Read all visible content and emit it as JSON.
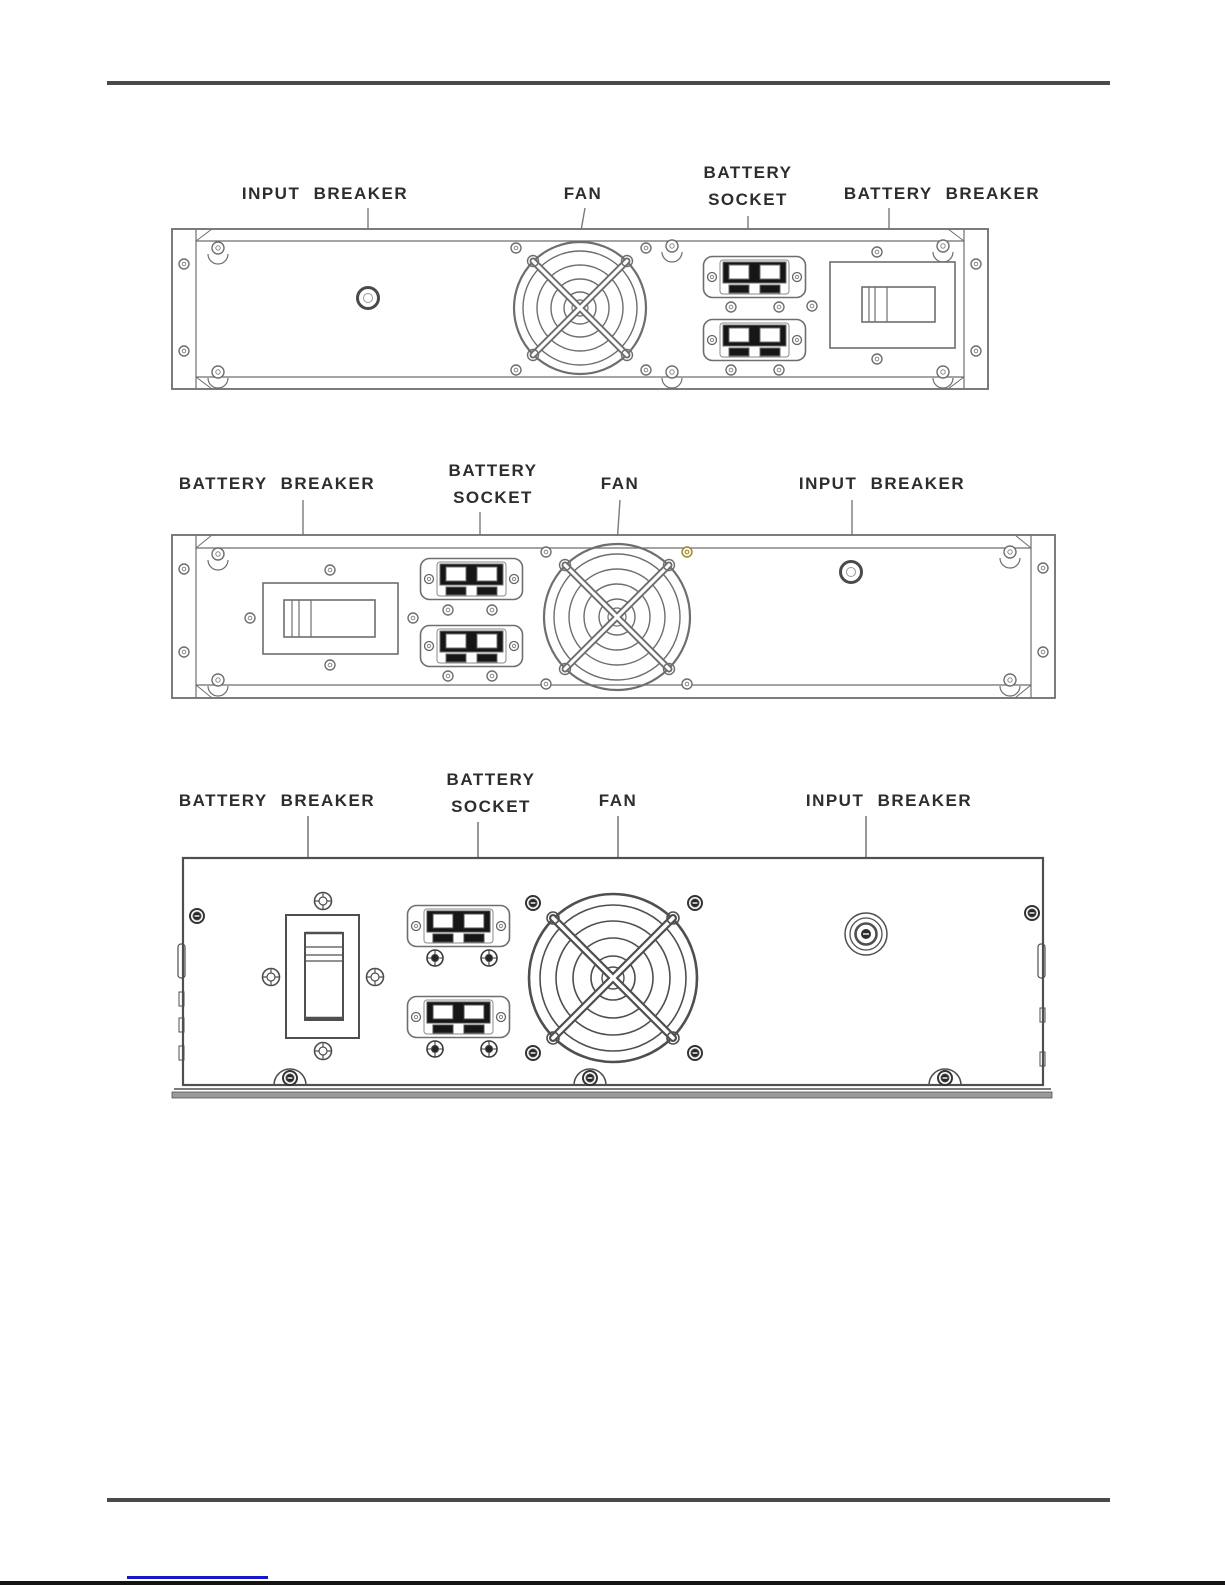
{
  "diagrams": [
    {
      "position": "top",
      "unit": "battery-module-rear-panel-2u",
      "labels": {
        "input_breaker": "INPUT BREAKER",
        "fan": "FAN",
        "battery_socket_line1": "BATTERY",
        "battery_socket_line2": "SOCKET",
        "battery_breaker": "BATTERY BREAKER"
      }
    },
    {
      "position": "middle",
      "unit": "battery-module-rear-panel-2u-mirrored",
      "labels": {
        "battery_breaker": "BATTERY BREAKER",
        "battery_socket_line1": "BATTERY",
        "battery_socket_line2": "SOCKET",
        "fan": "FAN",
        "input_breaker": "INPUT BREAKER"
      }
    },
    {
      "position": "bottom",
      "unit": "battery-module-rear-panel-3u",
      "labels": {
        "battery_breaker": "BATTERY BREAKER",
        "battery_socket_line1": "BATTERY",
        "battery_socket_line2": "SOCKET",
        "fan": "FAN",
        "input_breaker": "INPUT BREAKER"
      }
    }
  ],
  "colors": {
    "line": "#6e6e6e",
    "line_dark": "#4f4f4f",
    "text": "#2d2d2d",
    "rule": "#4a4a4a",
    "link_underline": "#1515cc",
    "connector_fill": "#161616"
  }
}
